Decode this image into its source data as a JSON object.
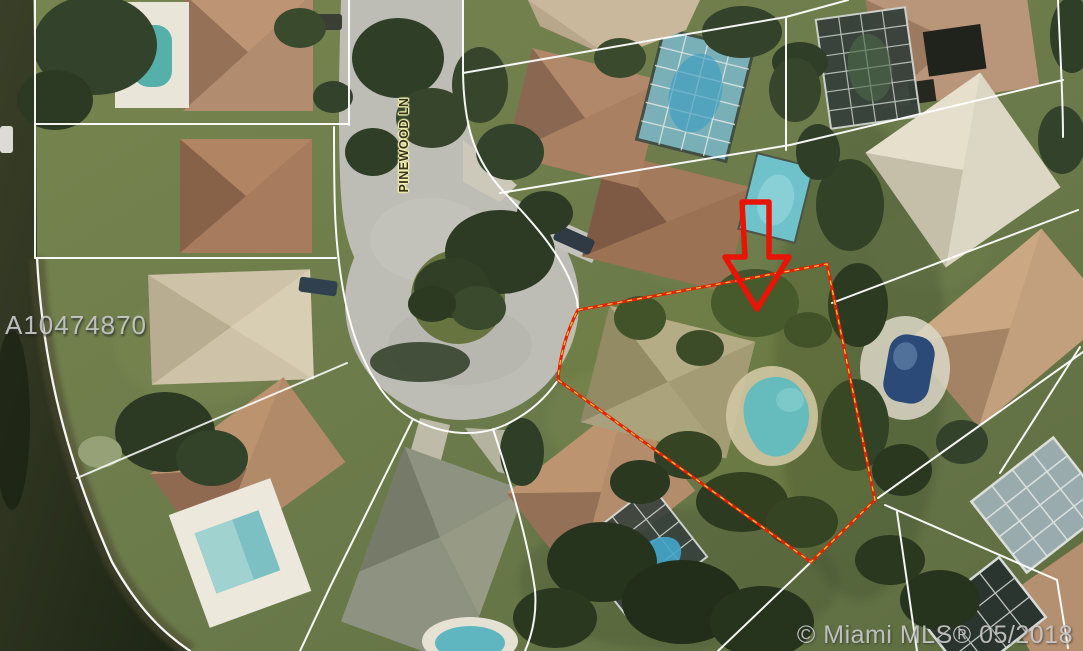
{
  "image": {
    "type": "aerial-map-photo",
    "width": 1083,
    "height": 651,
    "features": [
      "lake at lower-left",
      "cul-de-sac street",
      "residential lots with houses and pools",
      "white parcel boundary lines",
      "red outlined subject parcel",
      "red arrow marker pointing at subject lot"
    ]
  },
  "labels": {
    "watermark": "A10474870",
    "street": "PINEWOOD LN",
    "copyright": "© Miami MLS® 05/2018"
  },
  "annotations": {
    "subject_parcel": {
      "outline_color": "#e02500",
      "dash_color": "#ffc24d",
      "style": "solid red outline with yellow center dashes"
    },
    "arrow": {
      "color": "#e81406",
      "direction": "down",
      "style": "hollow red outline arrow"
    }
  },
  "colors": {
    "boundary_lines": "#ffffff",
    "lawn": "#6d7c4c",
    "road": "#bdbdb5",
    "lake": "#242e1b",
    "pool_water": "#62bac4",
    "roof_tan": "#b18b69",
    "roof_gray": "#8e9280",
    "subject_roof": "#a8a07f",
    "watermark_text": "#c9c9c9",
    "street_label_text": "#33331c",
    "street_label_halo": "#f4f0ac",
    "copyright_text": "#cfcfcf"
  }
}
